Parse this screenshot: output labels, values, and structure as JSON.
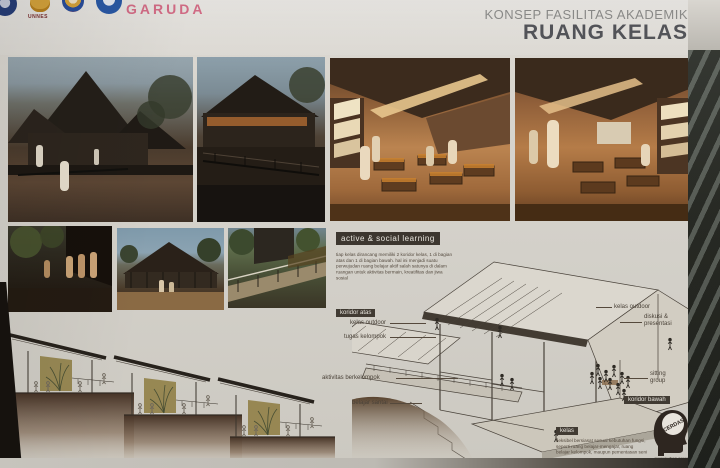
{
  "header": {
    "title_line1": "KONSEP FASILITAS AKADEMIK",
    "title_line2": "RUANG KELAS",
    "logos": {
      "unnes_label": "UNNES",
      "garuda_tagline": "JAYA UNGGUL",
      "garuda_label": "GARUDA"
    }
  },
  "learning_section": {
    "tag": "active & social learning",
    "body": "tiap kelas dirancang memiliki 2 koridor kelas, 1 di bagian atas dan 1 di bagian bawah. hal ini menjadi suatu perwujudan ruang belajar aktif salah satunya di dalam ruangan untuk aktivitas bermain, kreatifitas dan jiwa sosial"
  },
  "axon_labels": {
    "koridor_atas": "koridor atas",
    "kelas_outdoor_left": "kelas outdoor",
    "tugas_kelompok": "tugas kelompok",
    "aktivitas_berkelompok": "aktivitas berkelompok",
    "belajar_santai": "belajar santai",
    "kelas_outdoor_right": "kelas outdoor",
    "diskusi_presentasi": "diskusi & presentasi",
    "sitting_group": "sitting group",
    "koridor_bawah": "koridor bawah"
  },
  "kelas_section": {
    "tag": "kelas",
    "body": "fleksibel bersiasat sesuai kebutuhan fungsi, seperti ruang belajar-mengajar, ruang belajar kelompok, maupun pementasan seni",
    "head_word": "CERDAS",
    "head_caption": "mewujudkan generasi cerdas & berjiwa sosial"
  },
  "icons": {
    "head": "cerdas-head-icon"
  },
  "colors": {
    "board": "#d6d3cc",
    "tag_dark": "#3c362f",
    "garuda_pink": "#d76e88",
    "title_grey": "#8d8d8b",
    "title_dark": "#54555a",
    "olive_wall": "#8d7b3f"
  }
}
